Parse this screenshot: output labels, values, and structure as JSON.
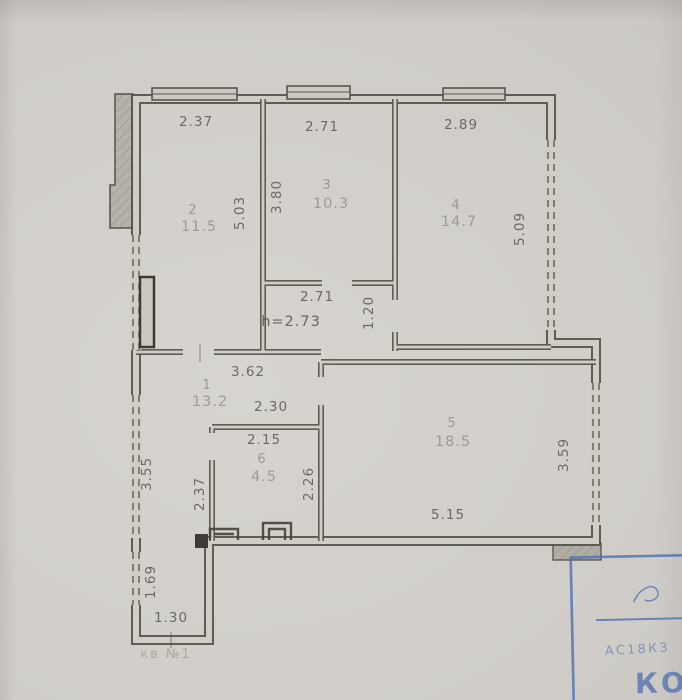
{
  "plan": {
    "rooms": {
      "r1": {
        "number": "1",
        "area": "13.2"
      },
      "r2": {
        "number": "2",
        "area": "11.5"
      },
      "r3": {
        "number": "3",
        "area": "10.3"
      },
      "r4": {
        "number": "4",
        "area": "14.7"
      },
      "r5": {
        "number": "5",
        "area": "18.5"
      },
      "r6": {
        "number": "6",
        "area": "4.5"
      }
    },
    "dims": {
      "room2_width": "2.37",
      "room3_width": "2.71",
      "room4_width": "2.89",
      "room2_depth": "5.03",
      "room3_depth": "3.80",
      "room4_depth": "5.09",
      "inner_corridor_width": "2.71",
      "ceiling_height": "h=2.73",
      "inner_corridor_depth": "1.20",
      "hall_width": "3.62",
      "hall_alcove_width": "2.30",
      "room6_width": "2.15",
      "room6_depth_right": "2.26",
      "room6_depth_left": "2.37",
      "hall_wall_left": "3.55",
      "room5_width": "5.15",
      "room5_depth": "3.59",
      "entry_depth": "1.69",
      "entry_width": "1.30"
    },
    "annotations": {
      "apartment_label": "кв №1"
    },
    "stamp": {
      "caption": "АС18КЗ",
      "initials": "КО"
    },
    "colors": {
      "ink": "#56524a",
      "faded_ink": "#7d786e",
      "stamp_blue": "#4e6fb2",
      "paper": "#d0cdc7"
    }
  }
}
